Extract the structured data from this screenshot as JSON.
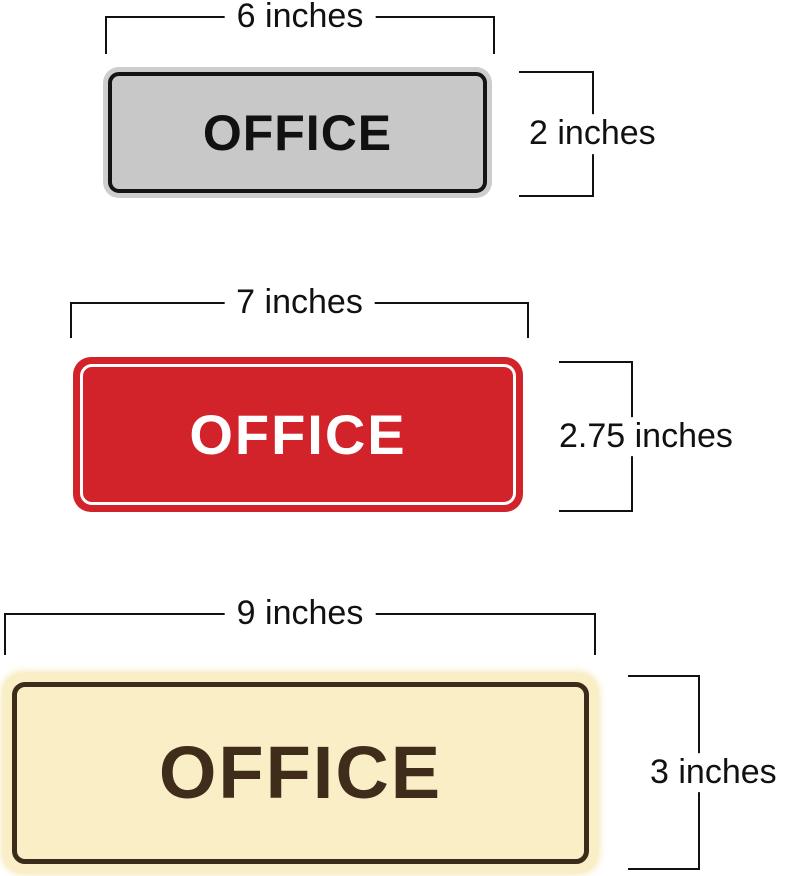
{
  "figure": {
    "background": "#ffffff",
    "annotation_color": "#111111",
    "signs": [
      {
        "name": "gray-office-sign",
        "text": "OFFICE",
        "width_label": "6 inches",
        "height_label": "2 inches",
        "colors": {
          "plate": "#cdcdcd",
          "face": "#c8c8c8",
          "border": "#141414",
          "text": "#111111"
        }
      },
      {
        "name": "red-office-sign",
        "text": "OFFICE",
        "width_label": "7 inches",
        "height_label": "2.75 inches",
        "colors": {
          "plate": "#d2232a",
          "pinstripe": "#ffffff",
          "text": "#ffffff"
        }
      },
      {
        "name": "cream-office-sign",
        "text": "OFFICE",
        "width_label": "9 inches",
        "height_label": "3 inches",
        "colors": {
          "plate": "#faeec6",
          "border": "#3a2b1b",
          "text": "#402c1b"
        }
      }
    ]
  }
}
